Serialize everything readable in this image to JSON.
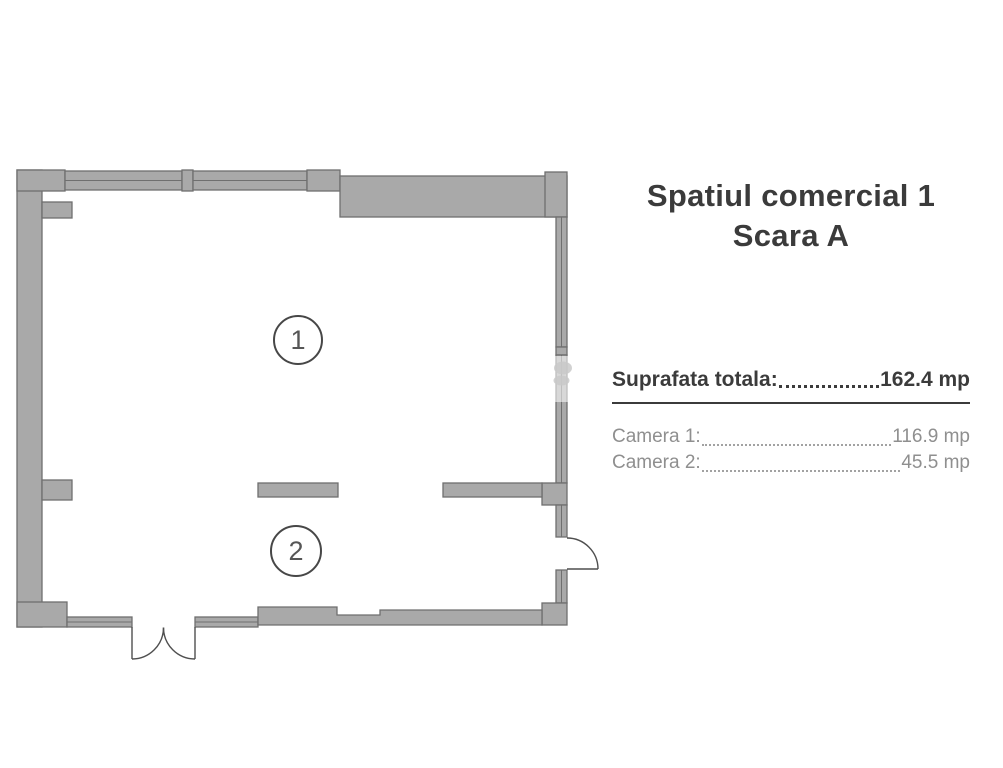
{
  "panel": {
    "title_line1": "Spatiul comercial 1",
    "title_line2": "Scara A",
    "total_label": "Suprafata totala:",
    "total_value": "162.4 mp",
    "rooms": [
      {
        "label": "Camera 1:",
        "value": "116.9 mp"
      },
      {
        "label": "Camera 2:",
        "value": "45.5 mp"
      }
    ]
  },
  "plan": {
    "room_markers": [
      {
        "number": "1"
      },
      {
        "number": "2"
      }
    ],
    "colors": {
      "wall_fill": "#a9a9a9",
      "wall_stroke": "#6f6f6f",
      "door_stroke": "#4f4f4f",
      "text_dark": "#3b3b3b",
      "text_muted": "#8f8f8f"
    }
  }
}
